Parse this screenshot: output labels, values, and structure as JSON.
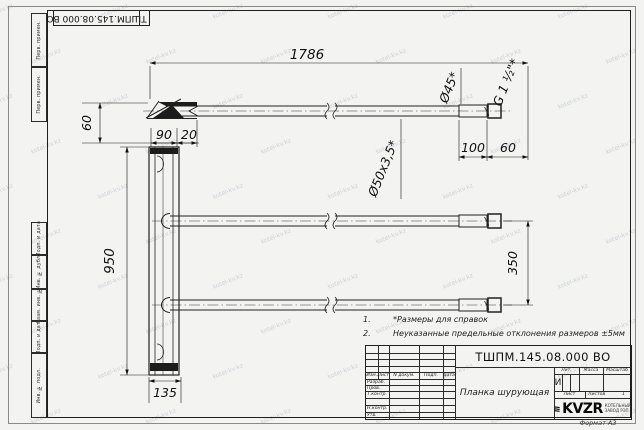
{
  "page": {
    "format_label": "Формат А3"
  },
  "corner_stamp": {
    "number": "ТШПМ.145.08.000 ВО"
  },
  "side_column": {
    "top": [
      "Перв. примен.",
      "Перв. примен."
    ],
    "bottom": [
      "Подп. и дата",
      "Инв. № дубл.",
      "Взам. инв. №",
      "Подп. и дата",
      "Инв. № подл."
    ]
  },
  "notes": [
    {
      "num": "1.",
      "text": "*Размеры для справок"
    },
    {
      "num": "2.",
      "text": "Неуказанные предельные отклонения размеров ±5мм"
    }
  ],
  "dimensions": {
    "length_total": "1786",
    "dia45": "Ø45*",
    "thread": "G 1 ½\"*",
    "dia50": "Ø50х3,5*",
    "dim100": "100",
    "dim60_right": "60",
    "dim60_left": "60",
    "dim90": "90",
    "dim20": "20",
    "dim950": "950",
    "dim350": "350",
    "dim135": "135"
  },
  "title_block": {
    "number": "ТШПМ.145.08.000 ВО",
    "part_name": "Планка шурующая",
    "header_cols": [
      "Изм.",
      "Лист",
      "N докум.",
      "Подп.",
      "Дата"
    ],
    "sign_rows": [
      "Разраб.",
      "Пров.",
      "Т.контр.",
      "Н.контр.",
      "Утв."
    ],
    "lit_label": "Лит.",
    "lit_value": "И",
    "mass_label": "Масса",
    "scale_label": "Масштаб",
    "sheet_label": "Лист",
    "sheets_label": "Листов",
    "sheets_value": "1",
    "company": {
      "logo_text": "KVZR",
      "line1": "КОТЕЛЬНЫЙ",
      "line2": "ЗАВОД РЭП"
    }
  },
  "watermark": {
    "text": "kotel-kv.kz"
  }
}
